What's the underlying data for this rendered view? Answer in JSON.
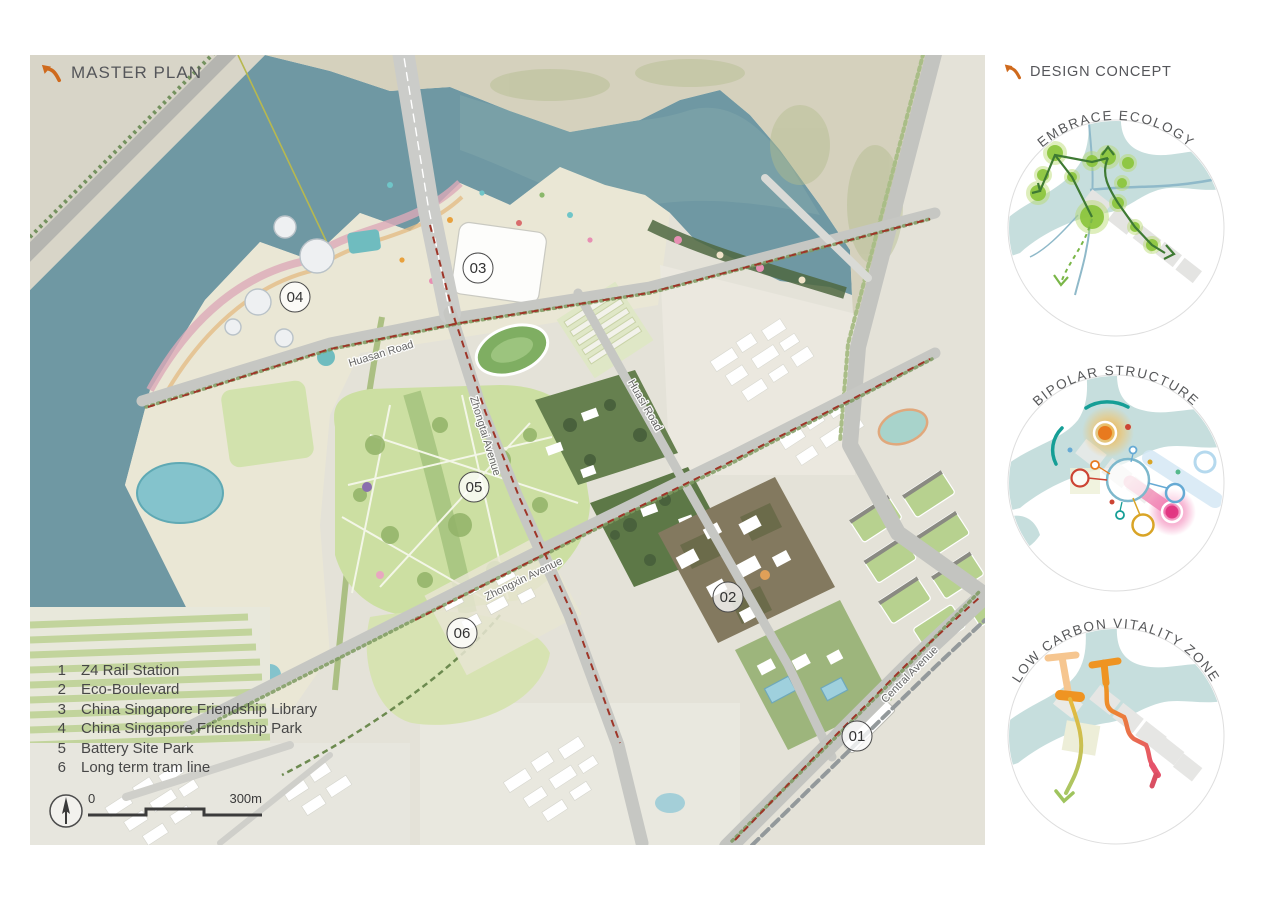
{
  "master_plan": {
    "title": "MASTER PLAN",
    "legend": [
      {
        "num": "1",
        "label": "Z4 Rail Station"
      },
      {
        "num": "2",
        "label": "Eco-Boulevard"
      },
      {
        "num": "3",
        "label": "China Singapore Friendship Library"
      },
      {
        "num": "4",
        "label": "China Singapore Friendship Park"
      },
      {
        "num": "5",
        "label": "Battery Site Park"
      },
      {
        "num": "6",
        "label": "Long term tram line"
      }
    ],
    "markers": [
      {
        "id": "01"
      },
      {
        "id": "02"
      },
      {
        "id": "03"
      },
      {
        "id": "04"
      },
      {
        "id": "05"
      },
      {
        "id": "06"
      }
    ],
    "roads": [
      {
        "name": "Huasan Road"
      },
      {
        "name": "Zhongtai Avenue"
      },
      {
        "name": "Zhongxin Avenue"
      },
      {
        "name": "Huasi Road"
      },
      {
        "name": "Central Avenue"
      }
    ],
    "scale": {
      "start": "0",
      "end": "300m"
    }
  },
  "design_concept": {
    "title": "DESIGN CONCEPT",
    "diagrams": [
      {
        "label": "EMBRACE ECOLOGY"
      },
      {
        "label": "BIPOLAR STRUCTURE"
      },
      {
        "label": "LOW CARBON VITALITY ZONE"
      }
    ]
  },
  "colors": {
    "accent_orange": "#cf6a1d",
    "water": "#6f98a3",
    "park_green": "#ccdfa2",
    "diagram_water": "#c6dedd",
    "eco_node_green": "#8dc63f",
    "tram_red": "#9e3528",
    "pink_pole": "#ec4f8e",
    "orange_pole": "#ef9422",
    "teal_arc": "#159e96"
  }
}
